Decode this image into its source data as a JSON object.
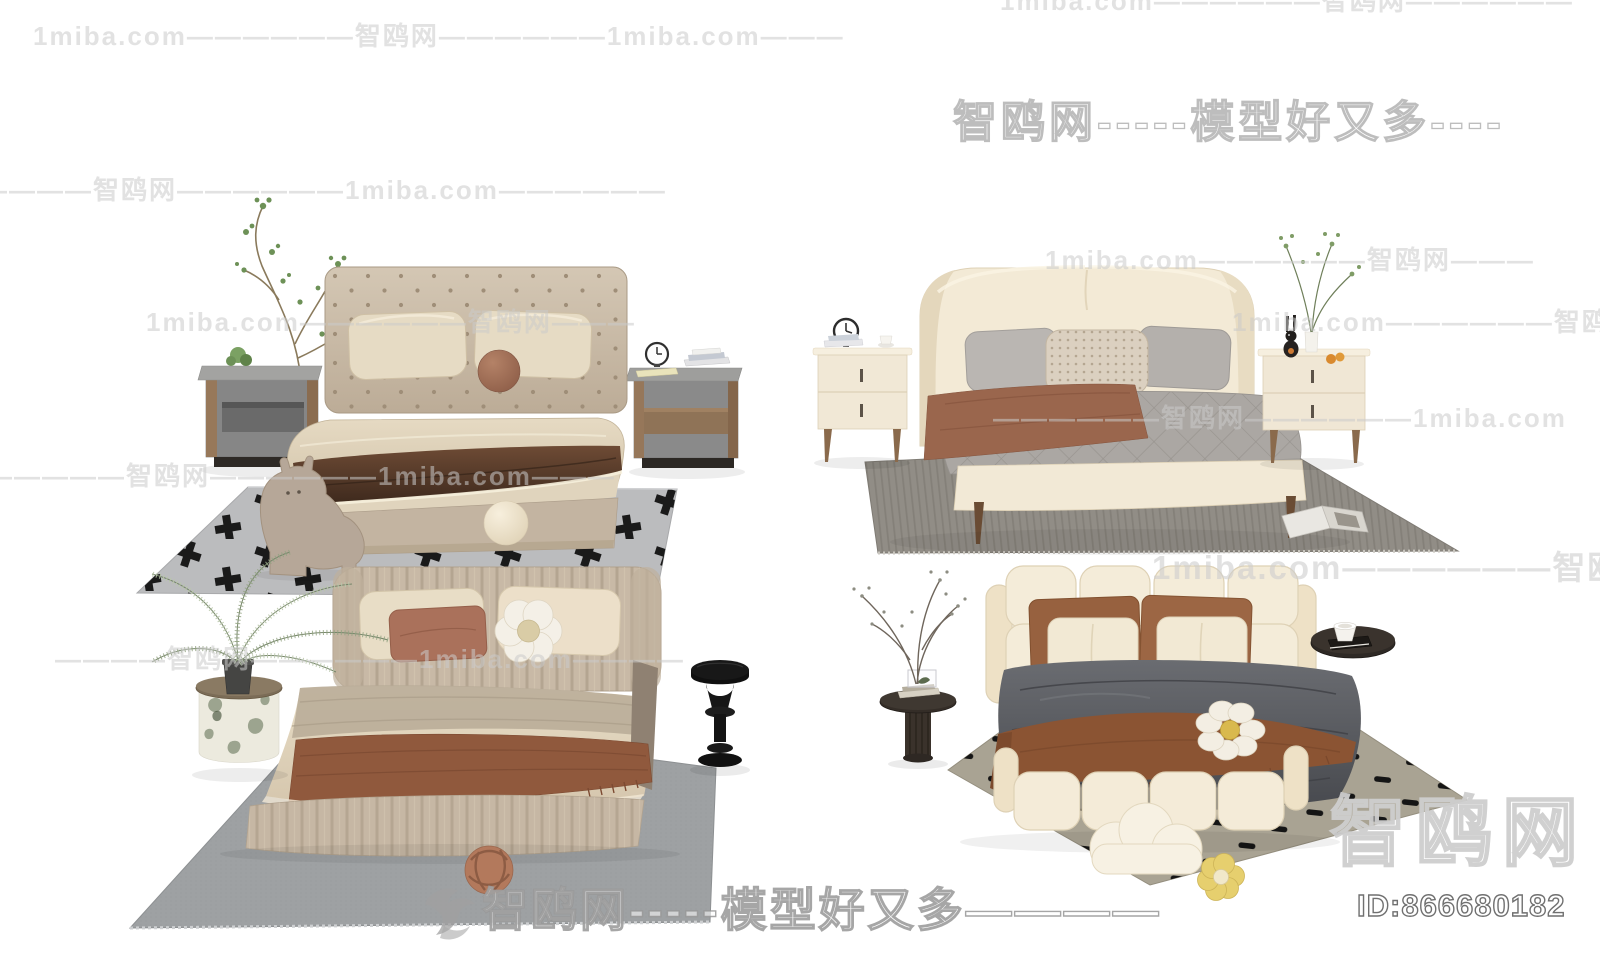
{
  "page": {
    "width": 1600,
    "height": 967,
    "background": "#ffffff"
  },
  "watermarks": {
    "site": "1miba.com",
    "brand": "智鸥网",
    "tagline": "模型好又多",
    "brand_large": "智鸥网",
    "model_id": "ID:866680182",
    "rows": {
      "r0": "1miba.com——————智鸥网——————",
      "r1": "1miba.com——————智鸥网——————1miba.com———",
      "r2": "智鸥网-----模型好又多----",
      "r3": "——————智鸥网——————1miba.com——————",
      "r4": "1miba.com——————智鸥网———",
      "r5a": "1miba.com——————智鸥网———",
      "r5b": "1miba.com——————智鸥网",
      "r6": "——————智鸥网——————1miba.com",
      "r7": "——————智鸥网——————1miba.com———",
      "r8": "1miba.com——————智鸥网——————",
      "r9": "————智鸥网——————1miba.com————",
      "r11": "智鸥网-----模型好又多————"
    }
  },
  "scenes": {
    "top_left": {
      "name": "button-tufted-bed-set",
      "items": [
        "branch-plant",
        "wood-nightstand-with-plant",
        "button-tufted-bed",
        "two-pillows",
        "brown-ball-cushion",
        "dark-brown-blanket",
        "wood-nightstand-with-clock-and-books",
        "pony-stool",
        "cream-ball-cushion",
        "cross-pattern-rug"
      ]
    },
    "top_right": {
      "name": "wing-headboard-bed-set",
      "items": [
        "cream-nightstand-with-clock-books-cup",
        "wing-headboard-bed",
        "gray-pillows",
        "woven-center-pillow",
        "quilted-gray-duvet",
        "brown-throw",
        "cream-nightstand-with-rabbit-plant-oranges",
        "tall-green-plant",
        "striped-gray-rug",
        "open-magazine"
      ]
    },
    "bottom_left": {
      "name": "channel-tufted-bed-set",
      "items": [
        "fern-plant",
        "green-marble-side-table",
        "channel-tufted-bed",
        "beige-pillows",
        "terracotta-pillow",
        "white-flower-pillow",
        "brown-throw",
        "black-sculptural-stool",
        "gray-rug",
        "knot-ball-cushion"
      ]
    },
    "bottom_right": {
      "name": "puffy-modular-bed-set",
      "items": [
        "dried-branch-plant",
        "dark-round-side-table-with-books",
        "puffy-modular-bed",
        "brown-pillows",
        "cream-pillows",
        "dark-gray-duvet",
        "fringed-brown-throw",
        "daisy-pillow",
        "cloud-pillow",
        "yellow-flower-pillow",
        "black-tray-table-with-cup",
        "dash-pattern-rug"
      ]
    }
  },
  "palette": {
    "background": "#ffffff",
    "watermark_gray": "#cacaca",
    "bed_cream": "#f3ead7",
    "bed_taupe": "#c8b9a6",
    "pillow_beige": "#e7dcc5",
    "terracotta": "#9c6a50",
    "dark_blanket": "#4a3425",
    "duvet_gray": "#aaa6a2",
    "duvet_dark": "#55575c",
    "throw_brown": "#8b5433",
    "rug_gray": "#b9babd",
    "rug_warm_gray": "#908c85",
    "rug_cool_gray": "#9ea1a3",
    "rug_olive": "#a9a393",
    "wood": "#8f7357",
    "black_accent": "#1a1a1a",
    "plant_green": "#6d9157",
    "fern_green": "#93a383",
    "orange_fruit": "#d98a2f"
  }
}
